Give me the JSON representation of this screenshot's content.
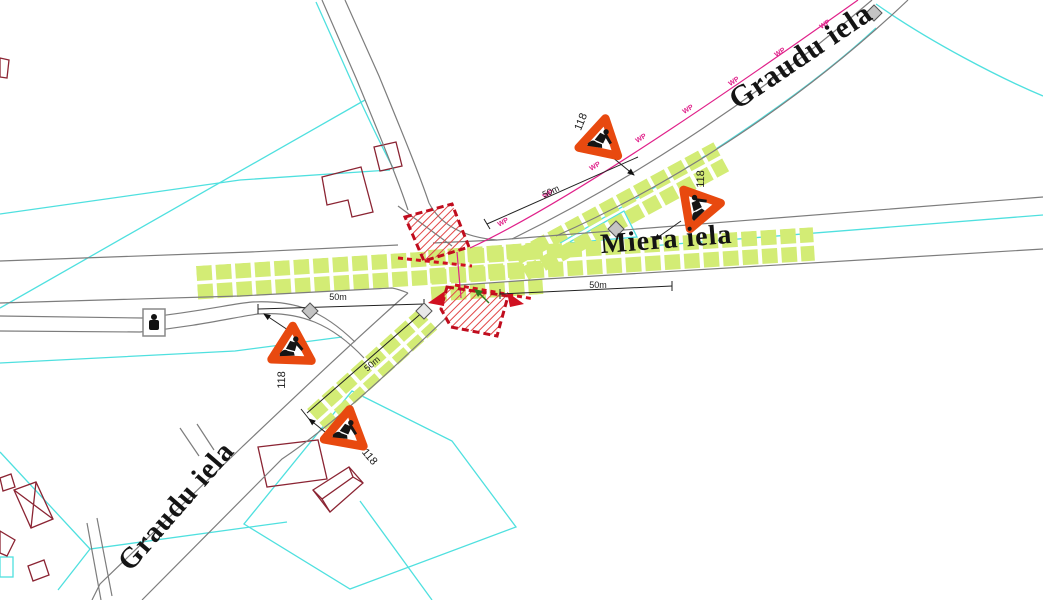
{
  "map": {
    "street_labels": [
      {
        "id": "graudu-iela-northeast",
        "text": "Graudu iela"
      },
      {
        "id": "miera-iela",
        "text": "Miera iela"
      },
      {
        "id": "graudu-iela-southwest",
        "text": "Graudu iela"
      }
    ],
    "signs": [
      {
        "id": "roadworks-sign-top",
        "code": "118"
      },
      {
        "id": "roadworks-sign-right",
        "code": "118"
      },
      {
        "id": "roadworks-sign-left",
        "code": "118"
      },
      {
        "id": "roadworks-sign-bottom",
        "code": "118"
      }
    ],
    "dimensions": [
      {
        "id": "dim-northeast-road",
        "text": "50m"
      },
      {
        "id": "dim-west-road",
        "text": "50m"
      },
      {
        "id": "dim-east-road",
        "text": "50m"
      },
      {
        "id": "dim-southwest-road",
        "text": "50m"
      }
    ],
    "wp_label": "WP",
    "colors": {
      "road_edge": "#7d7d7d",
      "parcel_boundary": "#4fe0df",
      "building_outline": "#8b2433",
      "temporary_marking_green": "#d3ec75",
      "work_zone_red": "#cf1020",
      "hatch_red": "#e24848",
      "sign_orange": "#e8490f",
      "utility_magenta": "#e0218a",
      "arrow_green": "#2d7a1e",
      "symbol_gray": "#c4c4c4"
    }
  }
}
